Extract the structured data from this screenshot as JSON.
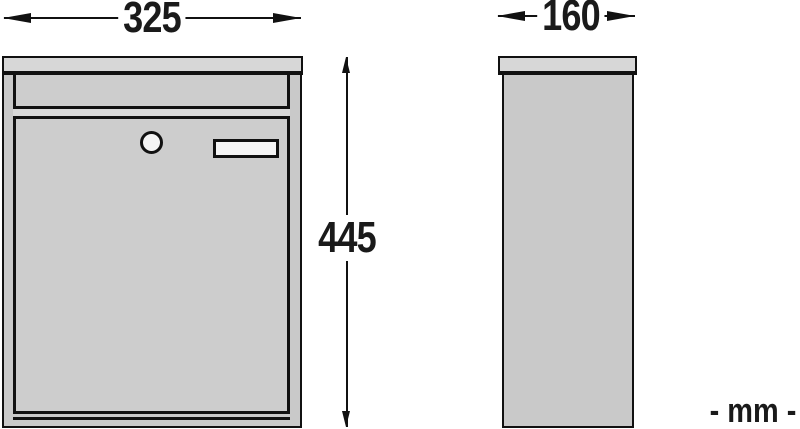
{
  "diagram": {
    "unit_label": "- mm -",
    "dimensions": {
      "front_width": {
        "value": "325",
        "orientation": "horizontal",
        "applies_to": "front view width"
      },
      "side_depth": {
        "value": "160",
        "orientation": "horizontal",
        "applies_to": "side view depth"
      },
      "height": {
        "value": "445",
        "orientation": "vertical",
        "applies_to": "overall height"
      }
    },
    "colors": {
      "background": "#ffffff",
      "line": "#111111",
      "text": "#1a1a1a",
      "body_fill": "#c9c9c9",
      "door_fill": "#cdcdcd",
      "lid_fill": "#d7d7d7",
      "flap_gap_fill": "#d9d9d9",
      "lock_fill": "#f5f5f5",
      "plate_fill": "#f5f5f5"
    }
  }
}
